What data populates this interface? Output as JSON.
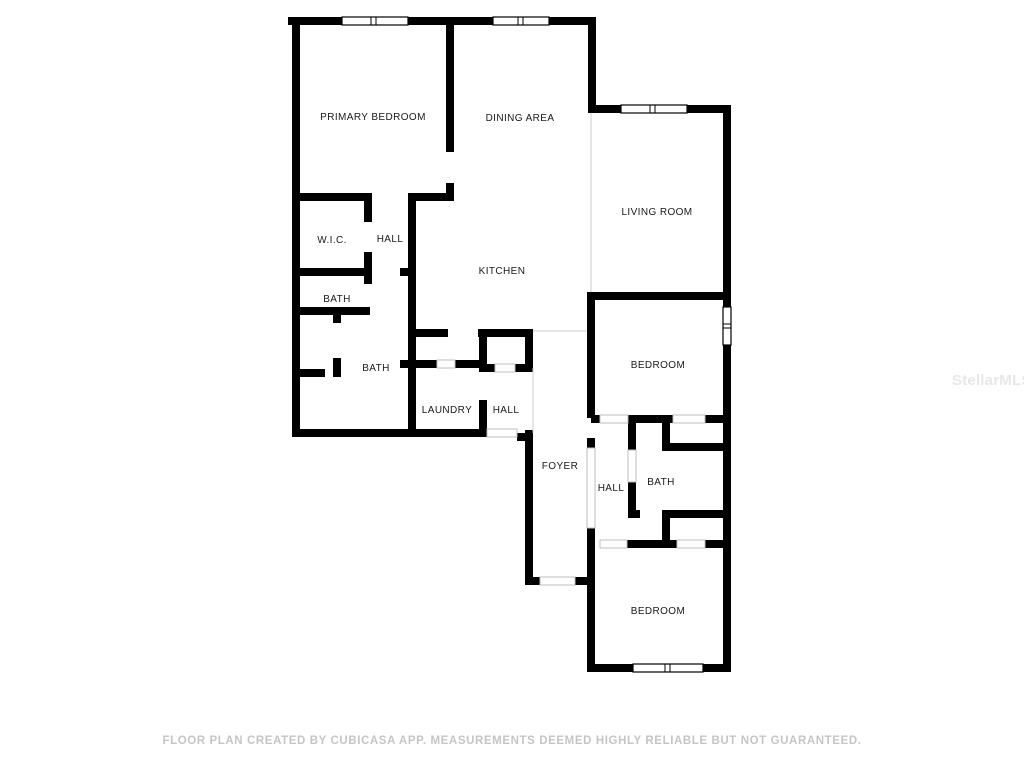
{
  "canvas": {
    "width": 1024,
    "height": 768,
    "background": "#ffffff"
  },
  "floorplan": {
    "wall_color": "#000000",
    "label_color": "#1a1a1a",
    "open_boundary_color": "#cccccc",
    "door_line_color": "#bdbdbd",
    "rooms": [
      {
        "label": "PRIMARY BEDROOM"
      },
      {
        "label": "DINING AREA"
      },
      {
        "label": "LIVING ROOM"
      },
      {
        "label": "W.I.C."
      },
      {
        "label": "HALL"
      },
      {
        "label": "KITCHEN"
      },
      {
        "label": "BATH"
      },
      {
        "label": "BATH"
      },
      {
        "label": "LAUNDRY"
      },
      {
        "label": "HALL"
      },
      {
        "label": "FOYER"
      },
      {
        "label": "BEDROOM"
      },
      {
        "label": "HALL"
      },
      {
        "label": "BATH"
      },
      {
        "label": "BEDROOM"
      }
    ]
  },
  "footer": {
    "text": "FLOOR PLAN CREATED BY CUBICASA APP. MEASUREMENTS DEEMED HIGHLY RELIABLE BUT NOT GUARANTEED."
  },
  "watermark": {
    "text": "StellarMLS"
  }
}
